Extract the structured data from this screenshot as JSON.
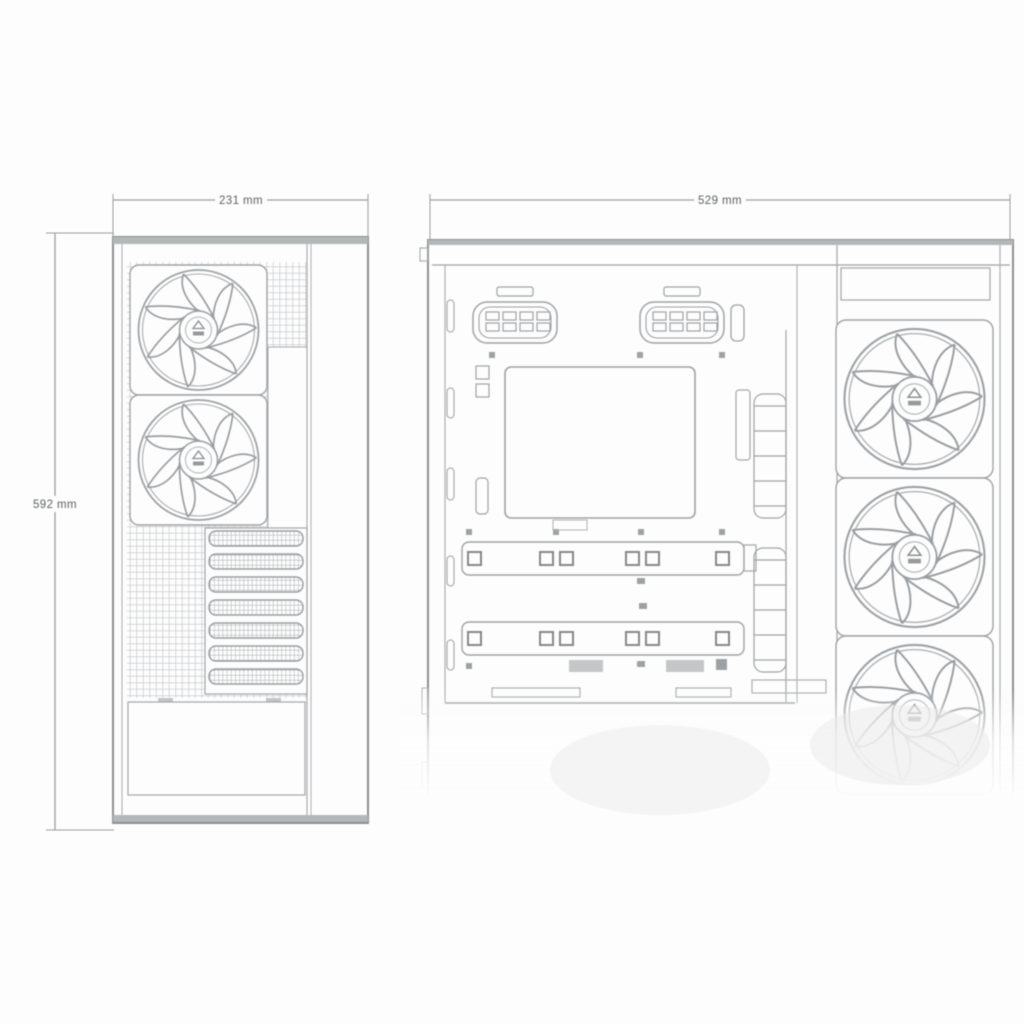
{
  "diagram": {
    "subject": "PC case technical dimension drawing, front view and side view",
    "dimensions": {
      "front_width": "231 mm",
      "height": "592 mm",
      "side_width": "529 mm"
    },
    "front_view": {
      "fans": 2,
      "vent_slat_rows": 7
    },
    "side_view": {
      "fans": 3,
      "cable_grommets": 2
    },
    "colors": {
      "line": "#9fa2a5",
      "line_dark": "#8d9093",
      "band_fill": "#b4b7b8",
      "text": "#5d6164",
      "background": "#fdfdfd"
    }
  }
}
